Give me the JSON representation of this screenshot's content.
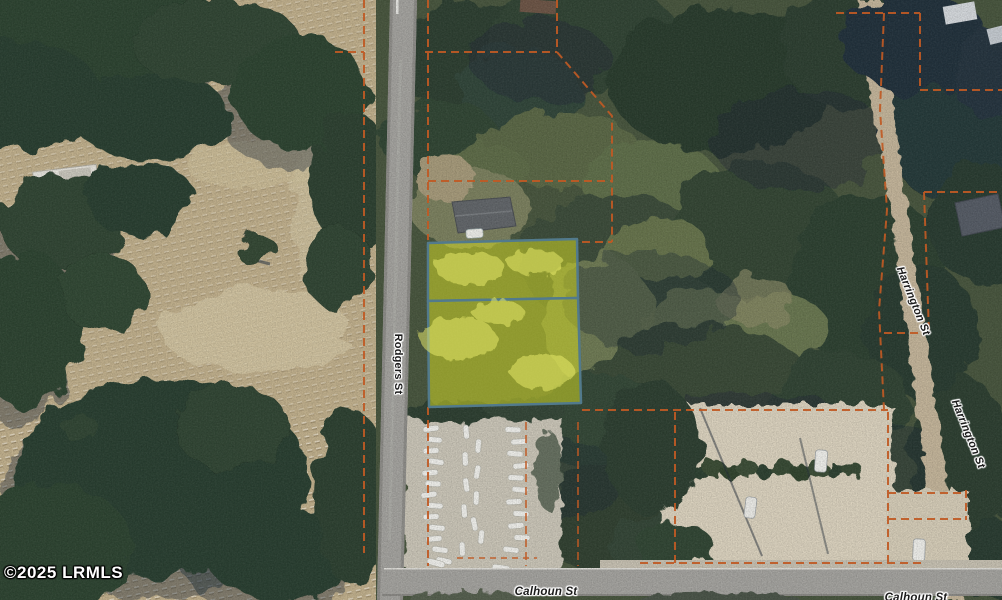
{
  "watermark": {
    "text": "©2025 LRMLS"
  },
  "streets": {
    "rodgers": {
      "label": "Rodgers St"
    },
    "harrington": {
      "label": "Harrington St"
    },
    "calhoun": {
      "label": "Calhoun St"
    }
  },
  "parcel_overlay": {
    "highlight_fill": "#cdd626",
    "highlight_outline": "#527a8c",
    "boundary_dash_color": "#c05a24",
    "sub_parcel_count": 2
  }
}
